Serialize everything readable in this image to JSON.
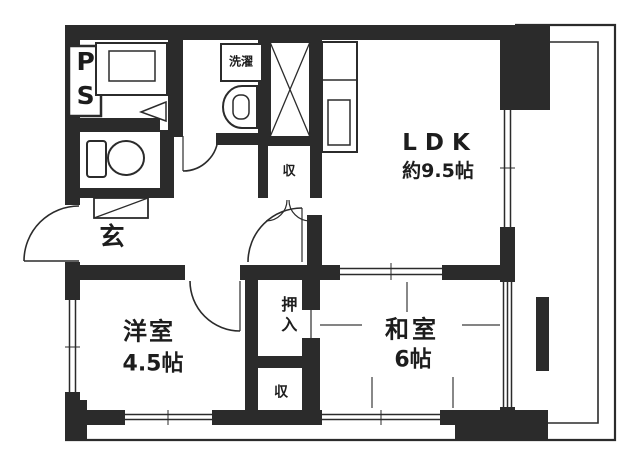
{
  "floorplan": {
    "bg_color": "#ffffff",
    "wall_color": "#2b2b2b",
    "labels": {
      "pipe_space": "PS",
      "laundry": "洗濯",
      "ldk_name": "LDK",
      "ldk_size": "約9.5帖",
      "storage_hall": "収",
      "entrance": "玄",
      "western_room_name": "洋室",
      "western_room_size": "4.5帖",
      "closet": "押入",
      "storage_bottom": "収",
      "japanese_room_name": "和室",
      "japanese_room_size": "6帖"
    }
  }
}
